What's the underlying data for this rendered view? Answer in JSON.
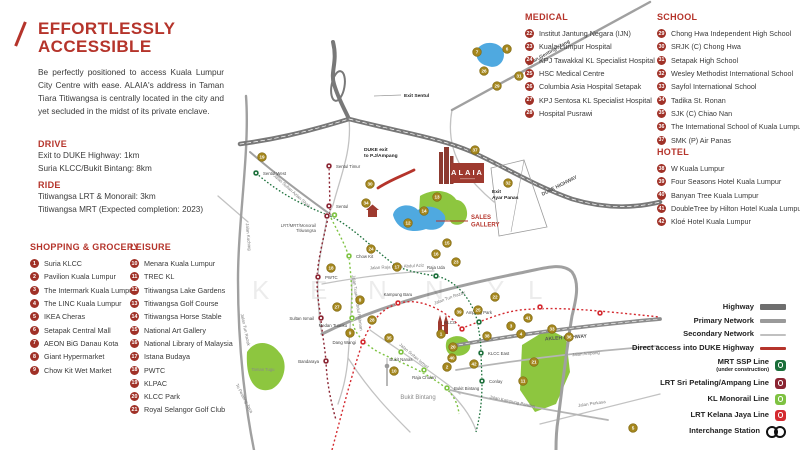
{
  "colors": {
    "accent": "#b5342b",
    "marker": "#a5871e",
    "highway": "#787878",
    "primary_road": "#a0a0a0",
    "secondary_road": "#c2c2c2",
    "lake": "#4fa9e0",
    "park": "#8dc63f",
    "mrt_ssp": "#1b6f3a",
    "lrt_ampang": "#8a2432",
    "monorail": "#7ec242",
    "lrt_kj": "#d42a30"
  },
  "intro": {
    "title1": "EFFORTLESSLY",
    "title2": "ACCESSIBLE",
    "body": "Be perfectly positioned to access Kuala Lumpur City Centre with ease. ALAIA's address in Taman Tiara Titiwangsa is centrally located in the city and yet secluded in the midst of its private enclave."
  },
  "drive": {
    "heading": "DRIVE",
    "line1": "Exit to DUKE Highway: 1km",
    "line2": "Suria KLCC/Bukit Bintang: 8km"
  },
  "ride": {
    "heading": "RIDE",
    "line1": "Titiwangsa LRT & Monorail: 3km",
    "line2": "Titiwangsa MRT (Expected completion: 2023)"
  },
  "categories": [
    {
      "heading": "SHOPPING & GROCERY",
      "left": 30,
      "top": 242,
      "items": [
        {
          "num": 1,
          "label": "Suria KLCC"
        },
        {
          "num": 2,
          "label": "Pavilion Kuala Lumpur"
        },
        {
          "num": 3,
          "label": "The Intermark Kuala Lumpur"
        },
        {
          "num": 4,
          "label": "The LINC Kuala Lumpur"
        },
        {
          "num": 5,
          "label": "IKEA Cheras"
        },
        {
          "num": 6,
          "label": "Setapak Central Mall"
        },
        {
          "num": 7,
          "label": "AEON BiG Danau Kota"
        },
        {
          "num": 8,
          "label": "Giant Hypermarket"
        },
        {
          "num": 9,
          "label": "Chow Kit Wet Market"
        }
      ]
    },
    {
      "heading": "LEISURE",
      "left": 130,
      "top": 242,
      "items": [
        {
          "num": 10,
          "label": "Menara Kuala Lumpur"
        },
        {
          "num": 11,
          "label": "TREC KL"
        },
        {
          "num": 12,
          "label": "Titiwangsa Lake Gardens"
        },
        {
          "num": 13,
          "label": "Titiwangsa Golf Course"
        },
        {
          "num": 14,
          "label": "Titiwangsa Horse Stable"
        },
        {
          "num": 15,
          "label": "National Art Gallery"
        },
        {
          "num": 16,
          "label": "National Library of Malaysia"
        },
        {
          "num": 17,
          "label": "Istana Budaya"
        },
        {
          "num": 18,
          "label": "PWTC"
        },
        {
          "num": 19,
          "label": "KLPAC"
        },
        {
          "num": 20,
          "label": "KLCC Park"
        },
        {
          "num": 21,
          "label": "Royal Selangor Golf Club"
        }
      ]
    },
    {
      "heading": "MEDICAL",
      "left": 525,
      "top": 12,
      "items": [
        {
          "num": 22,
          "label": "Institut Jantung Negara (IJN)"
        },
        {
          "num": 23,
          "label": "Kuala Lumpur Hospital"
        },
        {
          "num": 24,
          "label": "KPJ Tawakkal KL Specialist Hospital"
        },
        {
          "num": 25,
          "label": "HSC Medical Centre"
        },
        {
          "num": 26,
          "label": "Columbia Asia Hospital Setapak"
        },
        {
          "num": 27,
          "label": "KPJ Sentosa KL Specialist Hospital"
        },
        {
          "num": 28,
          "label": "Hospital Pusrawi"
        }
      ]
    },
    {
      "heading": "SCHOOL",
      "left": 657,
      "top": 12,
      "items": [
        {
          "num": 29,
          "label": "Chong Hwa Independent High School"
        },
        {
          "num": 30,
          "label": "SRJK (C) Chong Hwa"
        },
        {
          "num": 31,
          "label": "Setapak High School"
        },
        {
          "num": 32,
          "label": "Wesley Methodist International School"
        },
        {
          "num": 33,
          "label": "Sayfol International School"
        },
        {
          "num": 34,
          "label": "Tadika St. Ronan"
        },
        {
          "num": 35,
          "label": "SJK (C) Chiao Nan"
        },
        {
          "num": 36,
          "label": "The International School of Kuala Lumpur"
        },
        {
          "num": 37,
          "label": "SMK (P) Air Panas"
        }
      ]
    },
    {
      "heading": "HOTEL",
      "left": 657,
      "top": 147,
      "items": [
        {
          "num": 38,
          "label": "W Kuala Lumpur"
        },
        {
          "num": 39,
          "label": "Four Seasons Hotel Kuala Lumpur"
        },
        {
          "num": 40,
          "label": "Banyan Tree Kuala Lumpur"
        },
        {
          "num": 41,
          "label": "DoubleTree by Hilton Hotel Kuala Lumpur"
        },
        {
          "num": 42,
          "label": "Kloé Hotel Kuala Lumpur"
        }
      ]
    }
  ],
  "legend": {
    "rows": [
      {
        "label": "Highway",
        "type": "bar",
        "color": "#6e6e6e",
        "h": 6
      },
      {
        "label": "Primary Network",
        "type": "bar",
        "color": "#9a9a9a",
        "h": 4
      },
      {
        "label": "Secondary Network",
        "type": "bar",
        "color": "#c0c0c0",
        "h": 2.5
      },
      {
        "label": "Direct access into DUKE Highway",
        "type": "bar",
        "color": "#b5342b",
        "h": 3.5
      },
      {
        "label": "MRT SSP Line",
        "note": "(under construction)",
        "type": "badge",
        "color": "#1b6f3a"
      },
      {
        "label": "LRT Sri Petaling/Ampang Line",
        "type": "badge",
        "color": "#8a2432"
      },
      {
        "label": "KL Monorail Line",
        "type": "badge",
        "color": "#7ec242"
      },
      {
        "label": "LRT Kelana Jaya Line",
        "type": "badge",
        "color": "#d42a30"
      },
      {
        "label": "Interchange Station",
        "type": "interchange"
      }
    ]
  },
  "map": {
    "alaia": {
      "name": "ALAIA"
    },
    "sales_gallery": {
      "line1": "SALES",
      "line2": "GALLERY"
    },
    "exit_labels": [
      {
        "lines": [
          "Exit Sentul"
        ],
        "x": 404,
        "y": 97
      },
      {
        "lines": [
          "DUKE exit",
          "to P.J/Ampang"
        ],
        "x": 364,
        "y": 151
      },
      {
        "lines": [
          "Exit",
          "Ayar Panas"
        ],
        "x": 492,
        "y": 193
      }
    ],
    "road_labels": [
      {
        "text": "Jalan Genting Klang",
        "x": 549,
        "y": 54,
        "r": -29,
        "b": 1
      },
      {
        "text": "DUKE HIGHWAY",
        "x": 560,
        "y": 187,
        "r": -27,
        "b": 1
      },
      {
        "text": "AKLEH HIGHWAY",
        "x": 566,
        "y": 339,
        "r": -4,
        "b": 1
      },
      {
        "text": "Jalan Ampang",
        "x": 586,
        "y": 355,
        "r": -5,
        "b": 0
      },
      {
        "text": "Jalan Tun Razak",
        "x": 244,
        "y": 330,
        "r": 78,
        "b": 0
      },
      {
        "text": "Jalan Tun Razak",
        "x": 450,
        "y": 299,
        "r": -20,
        "b": 0
      },
      {
        "text": "Jalan Sultan Azlan Shah",
        "x": 291,
        "y": 192,
        "r": 42,
        "b": 0
      },
      {
        "text": "Jalan Raja Muda Abdul Aziz",
        "x": 397,
        "y": 268,
        "r": -3,
        "b": 0
      },
      {
        "text": "Jalan Tuanku Abdul Rahman",
        "x": 356,
        "y": 303,
        "r": 82,
        "b": 0
      },
      {
        "text": "Jalan Sultan Ismail",
        "x": 413,
        "y": 357,
        "r": 40,
        "b": 0
      },
      {
        "text": "Jalan Kampung Pandan",
        "x": 512,
        "y": 403,
        "r": 12,
        "b": 0
      },
      {
        "text": "Jalan Perkasa",
        "x": 592,
        "y": 405,
        "r": -8,
        "b": 0
      },
      {
        "text": "To Petaling Jaya",
        "x": 243,
        "y": 399,
        "r": 62,
        "b": 0
      },
      {
        "text": "Jalan Kuching",
        "x": 247,
        "y": 237,
        "r": 85,
        "b": 0
      }
    ],
    "area_labels": [
      {
        "text": "Bukit Bintang",
        "x": 418,
        "y": 399,
        "size": 6
      },
      {
        "text": "Taman Tugu",
        "x": 263,
        "y": 371,
        "size": 4.2
      }
    ],
    "watermark": {
      "letters": [
        "K",
        "E",
        "N",
        "N",
        "Y",
        "L"
      ],
      "xs": [
        252,
        310,
        368,
        425,
        487,
        528
      ],
      "y": 299
    },
    "stations": [
      {
        "name": "Sentul Timur",
        "x": 329,
        "y": 166,
        "line": "ampang",
        "lx": 336,
        "ly": 168,
        "a": "start"
      },
      {
        "name": "Sentul",
        "x": 329,
        "y": 206,
        "line": "ampang",
        "lx": 336,
        "ly": 208,
        "a": "start"
      },
      {
        "name": "PWTC",
        "x": 318,
        "y": 277,
        "line": "ampang",
        "lx": 325,
        "ly": 279,
        "a": "start"
      },
      {
        "name": "Sultan Ismail",
        "x": 321,
        "y": 318,
        "line": "ampang",
        "lx": 314,
        "ly": 320,
        "a": "end"
      },
      {
        "name": "Bandaraya",
        "x": 326,
        "y": 361,
        "line": "ampang",
        "lx": 319,
        "ly": 363,
        "a": "end"
      },
      {
        "name": "",
        "x": 327,
        "y": 216,
        "line": "ampang",
        "lx": 0,
        "ly": 0,
        "a": "none"
      },
      {
        "name": "",
        "x": 334.5,
        "y": 215,
        "line": "mono",
        "lx": 0,
        "ly": 0,
        "a": "none"
      },
      {
        "name": "Chow Kit",
        "x": 349,
        "y": 256,
        "line": "mono",
        "lx": 356,
        "ly": 258,
        "a": "start"
      },
      {
        "name": "Medan Tuanku",
        "x": 352,
        "y": 318,
        "line": "mono",
        "lx": 347,
        "ly": 327,
        "a": "end"
      },
      {
        "name": "Bukit Nanas",
        "x": 401,
        "y": 352,
        "line": "mono",
        "lx": 401,
        "ly": 361,
        "a": "middle"
      },
      {
        "name": "Raja Chulan",
        "x": 424,
        "y": 370,
        "line": "mono",
        "lx": 424,
        "ly": 379,
        "a": "middle"
      },
      {
        "name": "Bukit Bintang",
        "x": 447,
        "y": 388,
        "line": "mono",
        "lx": 454,
        "ly": 390,
        "a": "start"
      },
      {
        "name": "Kampung Baru",
        "x": 398,
        "y": 303,
        "line": "kj",
        "lx": 398,
        "ly": 296,
        "a": "middle"
      },
      {
        "name": "Dang Wangi",
        "x": 363,
        "y": 342,
        "line": "kj",
        "lx": 356,
        "ly": 344,
        "a": "end"
      },
      {
        "name": "KLCC",
        "x": 462,
        "y": 329,
        "line": "kj",
        "lx": 456,
        "ly": 324,
        "a": "end"
      },
      {
        "name": "",
        "x": 540,
        "y": 307,
        "line": "kj",
        "lx": 0,
        "ly": 0,
        "a": "none"
      },
      {
        "name": "",
        "x": 600,
        "y": 313,
        "line": "kj",
        "lx": 0,
        "ly": 0,
        "a": "none"
      },
      {
        "name": "Sentul West",
        "x": 256,
        "y": 173,
        "line": "mrt",
        "lx": 263,
        "ly": 175,
        "a": "start"
      },
      {
        "name": "Raja Uda",
        "x": 436,
        "y": 276,
        "line": "mrt",
        "lx": 436,
        "ly": 269,
        "a": "middle"
      },
      {
        "name": "Ampang Park",
        "x": 479,
        "y": 322,
        "line": "mrt",
        "lx": 479,
        "ly": 314,
        "a": "middle"
      },
      {
        "name": "KLCC East",
        "x": 481,
        "y": 353,
        "line": "mrt",
        "lx": 488,
        "ly": 355,
        "a": "start"
      },
      {
        "name": "Conlay",
        "x": 482,
        "y": 381,
        "line": "mrt",
        "lx": 489,
        "ly": 383,
        "a": "start"
      }
    ],
    "interchange_label": {
      "lines": [
        "LRT/MRT/Monorail",
        "Titiwangsa"
      ],
      "x": 316,
      "y": 227
    },
    "markers": [
      [
        1,
        441,
        334
      ],
      [
        2,
        447,
        367
      ],
      [
        3,
        511,
        326
      ],
      [
        4,
        521,
        334
      ],
      [
        5,
        633,
        428
      ],
      [
        6,
        507,
        49
      ],
      [
        7,
        477,
        52
      ],
      [
        8,
        360,
        300
      ],
      [
        9,
        350,
        333
      ],
      [
        10,
        394,
        371
      ],
      [
        11,
        523,
        381
      ],
      [
        12,
        408,
        223
      ],
      [
        13,
        437,
        197
      ],
      [
        14,
        424,
        211
      ],
      [
        15,
        447,
        243
      ],
      [
        16,
        436,
        254
      ],
      [
        17,
        397,
        267
      ],
      [
        18,
        331,
        268
      ],
      [
        19,
        262,
        157
      ],
      [
        20,
        453,
        347
      ],
      [
        21,
        534,
        362
      ],
      [
        22,
        495,
        297
      ],
      [
        23,
        456,
        262
      ],
      [
        24,
        371,
        249
      ],
      [
        25,
        478,
        310
      ],
      [
        26,
        484,
        71
      ],
      [
        27,
        337,
        307
      ],
      [
        28,
        372,
        320
      ],
      [
        29,
        497,
        86
      ],
      [
        30,
        370,
        184
      ],
      [
        31,
        519,
        76
      ],
      [
        32,
        508,
        183
      ],
      [
        33,
        552,
        329
      ],
      [
        34,
        366,
        203
      ],
      [
        35,
        389,
        338
      ],
      [
        36,
        569,
        337
      ],
      [
        37,
        475,
        150
      ],
      [
        38,
        487,
        336
      ],
      [
        39,
        459,
        312
      ],
      [
        40,
        452,
        358
      ],
      [
        41,
        528,
        318
      ],
      [
        42,
        474,
        364
      ]
    ]
  }
}
